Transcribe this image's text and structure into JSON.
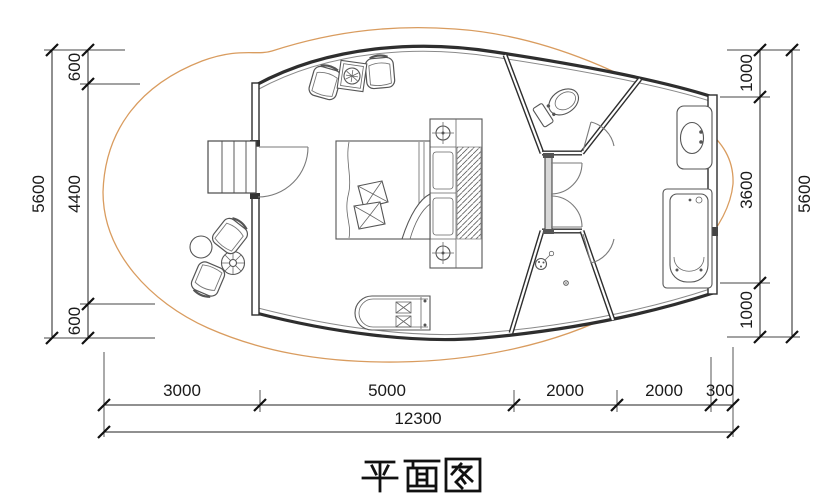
{
  "title": "平面图",
  "colors": {
    "background": "#ffffff",
    "wall_line": "#2e2e2e",
    "fixture_line": "#555555",
    "deck_hatch": "#dd9c5f",
    "dimension_text": "#1a1a1a",
    "partition_fill": "#d8d8d8"
  },
  "dimensions": {
    "left": {
      "overall": "5600",
      "segments": [
        "600",
        "4400",
        "600"
      ]
    },
    "right": {
      "overall": "5600",
      "segments": [
        "1000",
        "3600",
        "1000"
      ]
    },
    "bottom": {
      "overall": "12300",
      "segments": [
        "3000",
        "5000",
        "2000",
        "2000",
        "300"
      ]
    }
  },
  "fixtures": {
    "bedroom": [
      "double-bed",
      "pillows",
      "duvet",
      "nightstand-lamp-top",
      "nightstand-lamp-bottom",
      "wardrobe-hanging-rail",
      "lounge-chair-left",
      "fire-table",
      "lounge-chair-right",
      "storage-bench"
    ],
    "bathroom": [
      "toilet",
      "toilet-door",
      "inner-door-top",
      "inner-door-bottom",
      "shower-head",
      "floor-drain",
      "shower-door",
      "washbasin",
      "bathtub"
    ],
    "deck": [
      "wood-plank-deck",
      "entry-steps",
      "entry-door",
      "side-table",
      "parasol-table",
      "deck-chair-upper",
      "deck-chair-lower"
    ]
  }
}
